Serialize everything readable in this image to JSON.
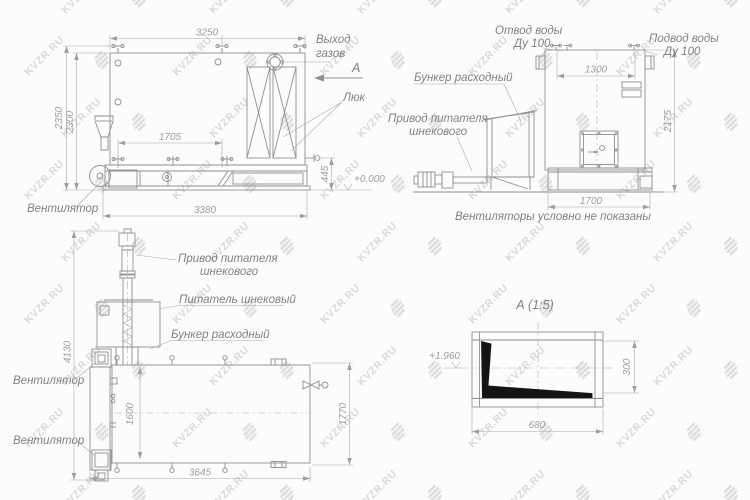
{
  "watermark": {
    "text": "KVZR.RU"
  },
  "side_view": {
    "dim_top_width": "3250",
    "dim_height_outer": "2350",
    "dim_height_inner": "2300",
    "dim_mid_width": "1705",
    "dim_base_width": "3380",
    "dim_base_height": "445",
    "level_mark": "+0.000",
    "label_gas_line1": "Выход",
    "label_gas_line2": "газов",
    "section_letter": "А",
    "label_hatch": "Люк",
    "label_fan": "Вентилятор"
  },
  "front_view": {
    "dim_pipe_spacing": "1300",
    "dim_height": "2175",
    "dim_base_width": "1700",
    "label_outlet_line1": "Отвод воды",
    "label_outlet_line2": "Ду 100",
    "label_inlet_line1": "Подвод воды",
    "label_inlet_line2": "Ду 100",
    "label_bunker": "Бункер расходный",
    "label_drive_line1": "Привод питателя",
    "label_drive_line2": "шнекового",
    "note": "Вентиляторы условно не показаны"
  },
  "plan_view": {
    "dim_total_height": "4130",
    "dim_inner_width": "1600",
    "dim_outer_width": "1770",
    "dim_length": "3645",
    "label_drive_line1": "Привод питателя",
    "label_drive_line2": "шнекового",
    "label_feeder": "Питатель шнековый",
    "label_bunker": "Бункер расходный",
    "label_fan_top": "Вентилятор",
    "label_fan_bottom": "Вентилятор"
  },
  "detail_view": {
    "title": "А (1:5)",
    "level_mark": "+1.960",
    "dim_width": "680",
    "dim_height": "300"
  }
}
